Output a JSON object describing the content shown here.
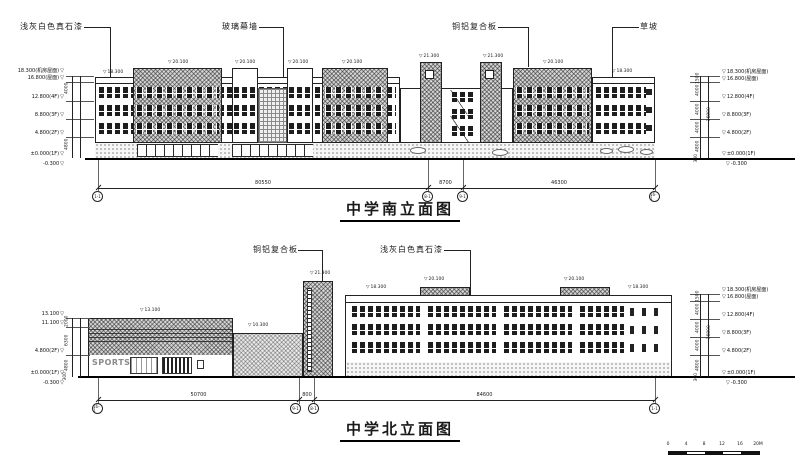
{
  "colors": {
    "line": "#1a1a1a",
    "brick_fill": "#d6d6d6",
    "paper": "#ffffff"
  },
  "south": {
    "title": "中学南立面图",
    "callouts": [
      "浅灰白色真石漆",
      "玻璃幕墙",
      "铜铝复合板",
      "草坡"
    ],
    "roof_marks": [
      "18.300",
      "20.100",
      "20.100",
      "20.100",
      "20.100",
      "21.300",
      "21.300",
      "20.100",
      "18.300"
    ],
    "levels": [
      "18.300(机房屋面)",
      "16.800(屋面)",
      "12.800(4F)",
      "8.800(3F)",
      "4.800(2F)",
      "±0.000(1F)",
      "-0.300"
    ],
    "dim_chain": [
      "1500",
      "4000",
      "4000",
      "4000",
      "4800",
      "300"
    ],
    "dim_total": "16800",
    "dims": [
      "80550",
      "8700",
      "46300"
    ],
    "grid_bubbles": [
      "1-1",
      "8-1",
      "9-1",
      "16-1"
    ]
  },
  "north": {
    "title": "中学北立面图",
    "callouts": [
      "铜铝复合板",
      "浅灰白色真石漆"
    ],
    "roof_marks": [
      "13.100",
      "10.300",
      "21.300",
      "18.300",
      "20.100",
      "20.100",
      "18.300"
    ],
    "levels_right": [
      "18.300(机房屋面)",
      "16.800(屋面)",
      "12.800(4F)",
      "8.800(3F)",
      "4.800(2F)",
      "±0.000(1F)",
      "-0.300"
    ],
    "levels_left": [
      "13.100",
      "11.100",
      "4.800(2F)",
      "±0.000(1F)",
      "-0.300"
    ],
    "dim_chain": [
      "1500",
      "4000",
      "4000",
      "4000",
      "4800",
      "300"
    ],
    "dim_chain_left": [
      "2000",
      "6300",
      "4800",
      "300"
    ],
    "dim_total": "16800",
    "dims": [
      "50700",
      "800",
      "84600"
    ],
    "grid_bubbles": [
      "16-1",
      "9-1",
      "8-1",
      "1-1"
    ],
    "sign": "SPORTS"
  },
  "scale_bar": {
    "labels": [
      "0",
      "4",
      "8",
      "12",
      "16",
      "20M"
    ]
  }
}
